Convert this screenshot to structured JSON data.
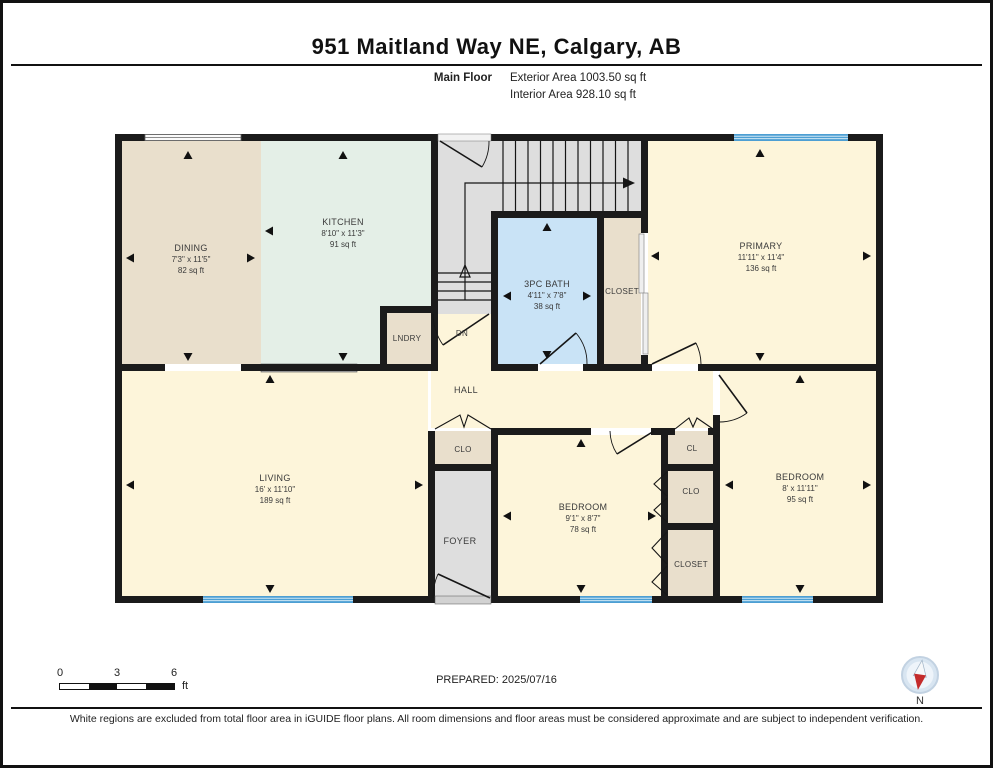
{
  "header": {
    "title": "951 Maitland Way NE, Calgary, AB",
    "floor_label": "Main Floor",
    "exterior_area": "Exterior Area 1003.50 sq ft",
    "interior_area": "Interior Area 928.10 sq ft"
  },
  "plan": {
    "rooms": {
      "dining": {
        "name": "DINING",
        "dims": "7'3\" x 11'5\"",
        "area": "82 sq ft"
      },
      "kitchen": {
        "name": "KITCHEN",
        "dims": "8'10\" x 11'3\"",
        "area": "91 sq ft"
      },
      "bath": {
        "name": "3PC BATH",
        "dims": "4'11\" x 7'8\"",
        "area": "38 sq ft"
      },
      "primary": {
        "name": "PRIMARY",
        "dims": "11'11\" x 11'4\"",
        "area": "136 sq ft"
      },
      "living": {
        "name": "LIVING",
        "dims": "16' x 11'10\"",
        "area": "189 sq ft"
      },
      "bedroom_mid": {
        "name": "BEDROOM",
        "dims": "9'1\" x 8'7\"",
        "area": "78 sq ft"
      },
      "bedroom_right": {
        "name": "BEDROOM",
        "dims": "8' x 11'11\"",
        "area": "95 sq ft"
      }
    },
    "small_rooms": {
      "lndry": "LNDRY",
      "hall": "HALL",
      "foyer": "FOYER",
      "dn": "DN",
      "closet_bath": "CLOSET",
      "clo_foyer": "CLO",
      "cl": "CL",
      "clo_right": "CLO",
      "closet_br": "CLOSET"
    }
  },
  "footer": {
    "scale_ticks": [
      "0",
      "3",
      "6"
    ],
    "scale_unit": "ft",
    "prepared": "PREPARED: 2025/07/16",
    "compass_label": "N",
    "disclaimer": "White regions are excluded from total floor area in iGUIDE floor plans. All room dimensions and floor areas must be considered approximate and are subject to independent verification."
  },
  "colors": {
    "wall": "#1b1b1b",
    "cream": "#fdf5da",
    "beige": "#e9dfcc",
    "mint": "#e4efe7",
    "bath_blue": "#c9e3f6",
    "floor_gray": "#dedede",
    "window_blue": "#4d9fd3",
    "compass_red": "#c42b2b"
  }
}
